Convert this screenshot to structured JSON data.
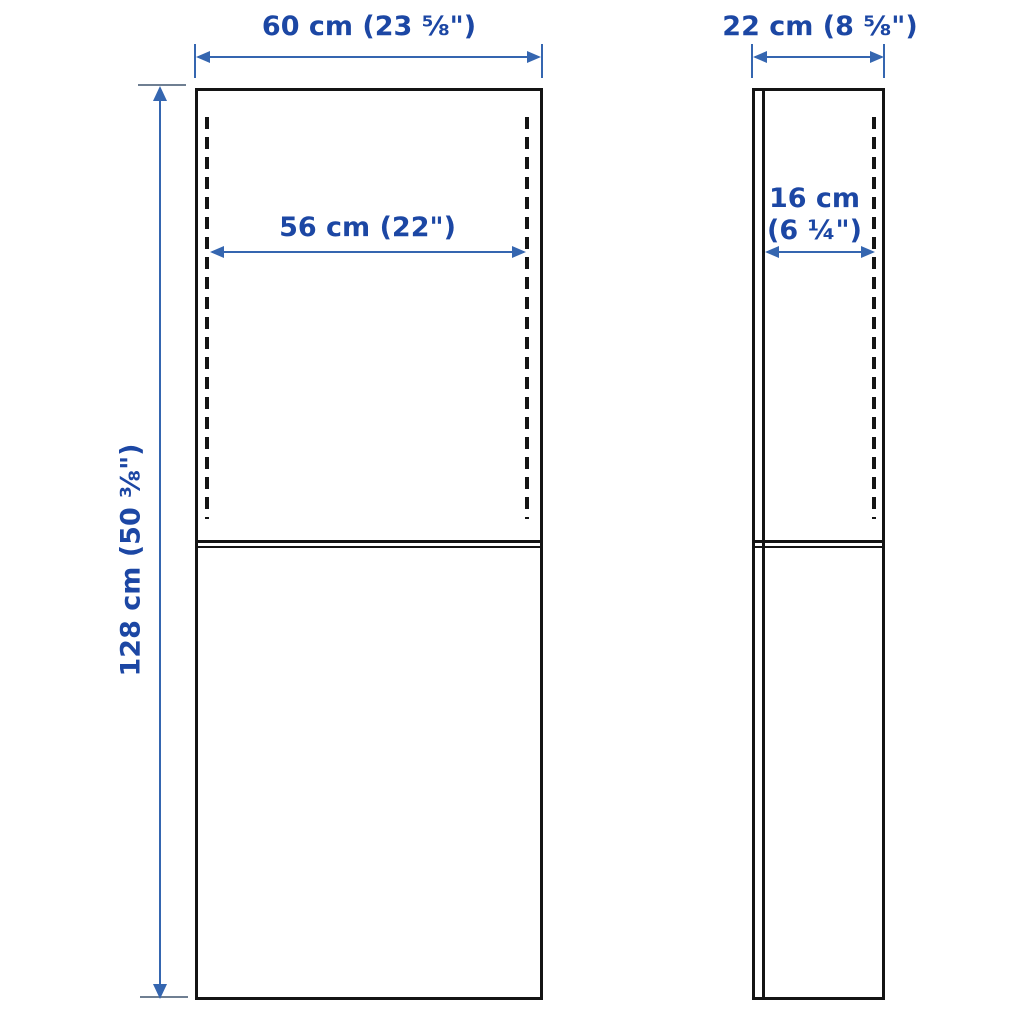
{
  "diagram": {
    "title": "furniture-dimension-drawing",
    "views": [
      "front",
      "side"
    ],
    "colors": {
      "outline": "#141414",
      "label_text": "#1c47a4",
      "dimension_line": "#3566b0",
      "extension_tick": "#6f7f92",
      "background": "#ffffff"
    }
  },
  "labels": {
    "front_width": "60 cm (23 ⅝\")",
    "front_inner_width": "56 cm (22\")",
    "height": "128 cm (50 ⅜\")",
    "side_depth": "22 cm (8 ⅝\")",
    "side_inner_depth_line1": "16 cm",
    "side_inner_depth_line2": "(6 ¼\")"
  },
  "dimensions": {
    "overall_width": {
      "cm": "60",
      "inches": "23 ⅝"
    },
    "inner_width": {
      "cm": "56",
      "inches": "22"
    },
    "overall_height": {
      "cm": "128",
      "inches": "50 ⅜"
    },
    "overall_depth": {
      "cm": "22",
      "inches": "8 ⅝"
    },
    "inner_depth": {
      "cm": "16",
      "inches": "6 ¼"
    }
  }
}
